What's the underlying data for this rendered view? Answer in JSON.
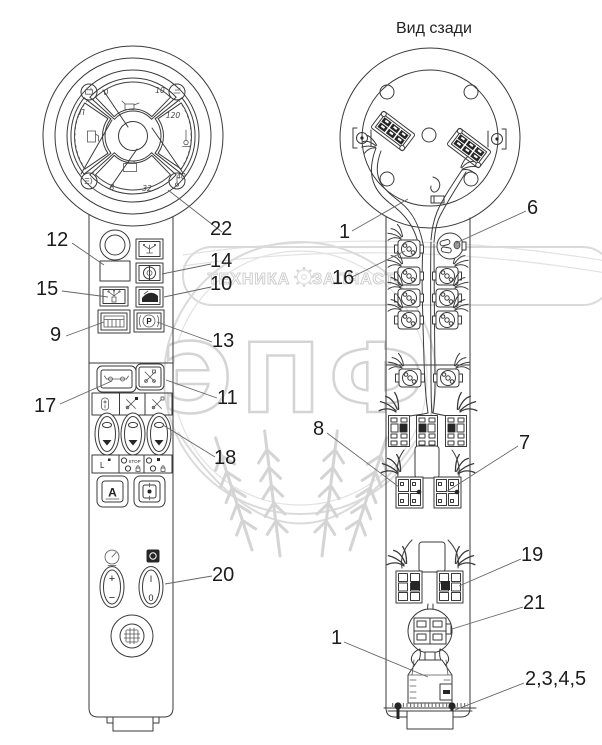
{
  "title": "Вид сзади",
  "watermark": {
    "brand_left": "ТЕХНИКА",
    "brand_right": "ЗАПЧАСТИ",
    "shield": "ЭПФ"
  },
  "cluster": {
    "oil_min": "0",
    "oil_max": "10",
    "fuel_full": "П",
    "temp_max": "120",
    "temp_min": "40",
    "volt_min": "8",
    "volt_max": "32"
  },
  "panel": {
    "auto": "A",
    "brake": "P",
    "stop": "STOP",
    "level": "L",
    "plus": "+",
    "minus": "−",
    "on": "I",
    "off": "0"
  },
  "callouts": [
    {
      "label": "22"
    },
    {
      "label": "12"
    },
    {
      "label": "14"
    },
    {
      "label": "10"
    },
    {
      "label": "15"
    },
    {
      "label": "9"
    },
    {
      "label": "13"
    },
    {
      "label": "17"
    },
    {
      "label": "11"
    },
    {
      "label": "18"
    },
    {
      "label": "20"
    },
    {
      "label": "1"
    },
    {
      "label": "6"
    },
    {
      "label": "16"
    },
    {
      "label": "8"
    },
    {
      "label": "7"
    },
    {
      "label": "19"
    },
    {
      "label": "21"
    },
    {
      "label": "1"
    },
    {
      "label": "2,3,4,5"
    }
  ]
}
